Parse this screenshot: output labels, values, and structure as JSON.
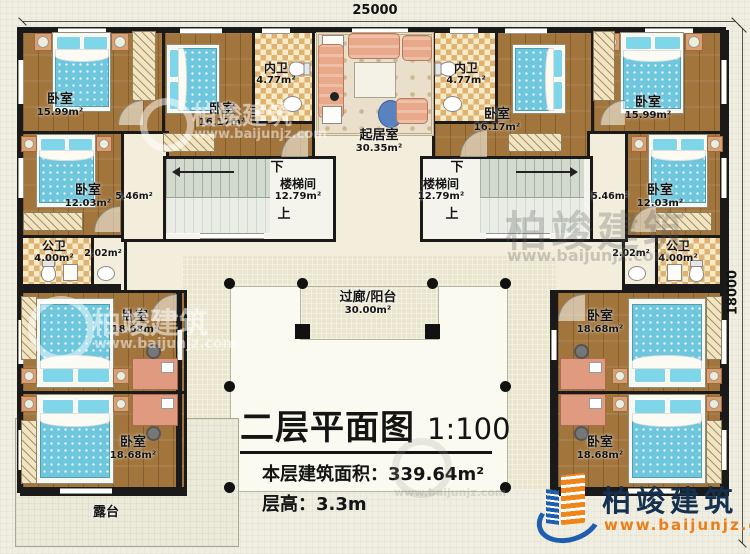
{
  "dimensions": {
    "width": "25000",
    "height": "18000"
  },
  "stairs": {
    "name": "楼梯间",
    "area": "12.79m²",
    "up": "上",
    "down": "下"
  },
  "corridor_area": "5.46m²",
  "small_hall_area": "2.02m²",
  "rooms": {
    "bedroom_tl": {
      "name": "卧室",
      "area": "15.99m²"
    },
    "bedroom_tl2": {
      "name": "卧室",
      "area": "16.17m²"
    },
    "bath_inner_left": {
      "name": "内卫",
      "area": "4.77m²"
    },
    "living": {
      "name": "起居室",
      "area": "30.35m²"
    },
    "bath_inner_right": {
      "name": "内卫",
      "area": "4.77m²"
    },
    "bedroom_tr2": {
      "name": "卧室",
      "area": "16.17m²"
    },
    "bedroom_tr": {
      "name": "卧室",
      "area": "15.99m²"
    },
    "bedroom_ml": {
      "name": "卧室",
      "area": "12.03m²"
    },
    "bedroom_mr": {
      "name": "卧室",
      "area": "12.03m²"
    },
    "bath_public_left": {
      "name": "公卫",
      "area": "4.00m²"
    },
    "bath_public_right": {
      "name": "公卫",
      "area": "4.00m²"
    },
    "bedroom_bl1": {
      "name": "卧室",
      "area": "18.68m²"
    },
    "bedroom_bl2": {
      "name": "卧室",
      "area": "18.68m²"
    },
    "bedroom_br1": {
      "name": "卧室",
      "area": "18.68m²"
    },
    "bedroom_br2": {
      "name": "卧室",
      "area": "18.68m²"
    },
    "balcony": {
      "name": "过廊/阳台",
      "area": "30.00m²"
    },
    "terrace": {
      "name": "露台"
    }
  },
  "title_block": {
    "title": "二层平面图",
    "scale": "1:100",
    "area_label": "本层建筑面积：",
    "area_value": "339.64m²",
    "height_label": "层高：",
    "height_value": "3.3m"
  },
  "logo": {
    "name": "柏竣建筑",
    "url": "www.baijunjz.com"
  },
  "watermark": {
    "name": "柏竣建筑",
    "url": "www.baijunjz.com"
  },
  "colors": {
    "accent_orange": "#ec7e19",
    "accent_blue": "#1e5eae",
    "wall": "#1a1a1a"
  }
}
